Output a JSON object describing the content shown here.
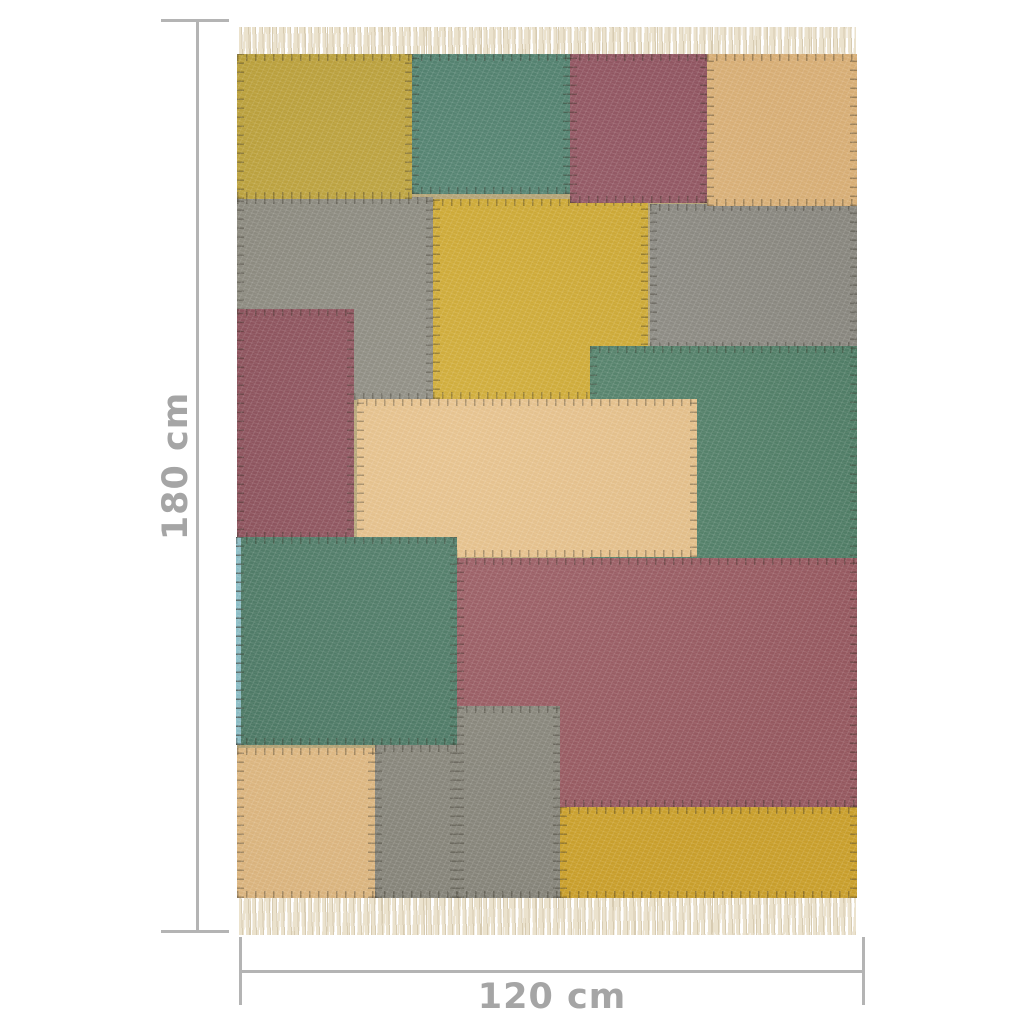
{
  "image": {
    "background": "#ffffff",
    "subject": "patchwork kilim rug, multicolour, with fringed ends"
  },
  "dimensions": {
    "height_label": "180 cm",
    "width_label": "120 cm",
    "line_color": "#b4b4b4",
    "label_color": "#a5a5a5"
  },
  "rug": {
    "fringe_color": "#ebe2cd",
    "fringe_shadow_color": "#d7cbb1",
    "stitch_color": "rgba(45,40,28,0.38)",
    "palette": {
      "yellow": "#c2a73e",
      "bright_yellow": "#d3ad33",
      "green": "#54836b",
      "maroon": "#975965",
      "tan": "#e2b77c",
      "gray": "#8f8d82",
      "selvage_blue": "#8fc2cb"
    },
    "patches": [
      {
        "name": "gray-left",
        "color": "#8f8d82",
        "x": 0,
        "y": 17.0,
        "w": 31.6,
        "h": 24.0
      },
      {
        "name": "gray-right",
        "color": "#8f8d85",
        "x": 66.6,
        "y": 17.8,
        "w": 33.4,
        "h": 17.2
      },
      {
        "name": "yellow-center",
        "color": "#d3ad33",
        "x": 31.6,
        "y": 17.2,
        "w": 34.7,
        "h": 23.7
      },
      {
        "name": "yellow-top-left",
        "color": "#c2a73e",
        "x": 0,
        "y": 0,
        "w": 28.2,
        "h": 17.2
      },
      {
        "name": "green-top",
        "color": "#558673",
        "x": 28.2,
        "y": 0,
        "w": 25.5,
        "h": 16.6
      },
      {
        "name": "maroon-top",
        "color": "#975965",
        "x": 53.7,
        "y": 0,
        "w": 22.1,
        "h": 17.6
      },
      {
        "name": "tan-top-right",
        "color": "#e2b77c",
        "x": 75.8,
        "y": 0,
        "w": 24.2,
        "h": 18.0
      },
      {
        "name": "maroon-left",
        "color": "#8f525c",
        "x": 0,
        "y": 30.2,
        "w": 18.9,
        "h": 27.3
      },
      {
        "name": "green-right",
        "color": "#54836b",
        "x": 56.9,
        "y": 34.6,
        "w": 43.1,
        "h": 25.9
      },
      {
        "name": "tan-center",
        "color": "#eac48c",
        "x": 19.4,
        "y": 40.9,
        "w": 54.8,
        "h": 18.7
      },
      {
        "name": "green-bottom-left",
        "color": "#4f7d68",
        "x": 0,
        "y": 57.2,
        "w": 35.5,
        "h": 24.7
      },
      {
        "name": "selvage-left",
        "color": "#8fc2cb",
        "x": -0.2,
        "y": 57.2,
        "w": 0.8,
        "h": 24.7
      },
      {
        "name": "maroon-bottom",
        "color": "#9d5d64",
        "x": 35.5,
        "y": 59.7,
        "w": 64.5,
        "h": 29.5
      },
      {
        "name": "gray-bottom-upper",
        "color": "#8c8a7f",
        "x": 35.5,
        "y": 77.3,
        "w": 16.6,
        "h": 22.7
      },
      {
        "name": "gray-bottom-lower",
        "color": "#8c8a7f",
        "x": 22.3,
        "y": 81.9,
        "w": 13.2,
        "h": 18.1
      },
      {
        "name": "tan-bottom-left",
        "color": "#e5bd85",
        "x": 0,
        "y": 82.2,
        "w": 22.3,
        "h": 17.8
      },
      {
        "name": "yellow-bottom-right",
        "color": "#d3a72e",
        "x": 52.1,
        "y": 89.2,
        "w": 47.9,
        "h": 10.8
      }
    ]
  }
}
